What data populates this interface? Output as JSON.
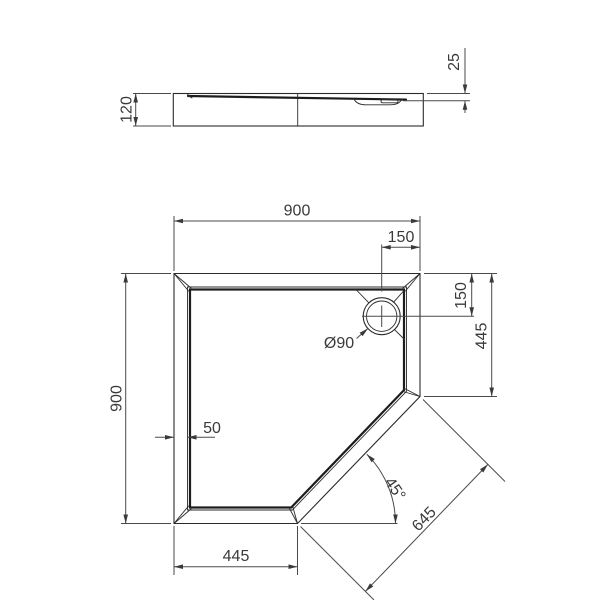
{
  "drawing": {
    "side_view": {
      "height": "120",
      "rim_to_ledge": "25"
    },
    "plan_view": {
      "width": "900",
      "depth": "900",
      "drain_offset_top": "150",
      "drain_offset_right": "150",
      "right_edge_to_cut": "445",
      "bottom_edge_to_cut": "445",
      "rim_width": "50",
      "drain_diameter": "Ø90",
      "cut_angle": "45°",
      "cut_edge_length": "645"
    }
  }
}
